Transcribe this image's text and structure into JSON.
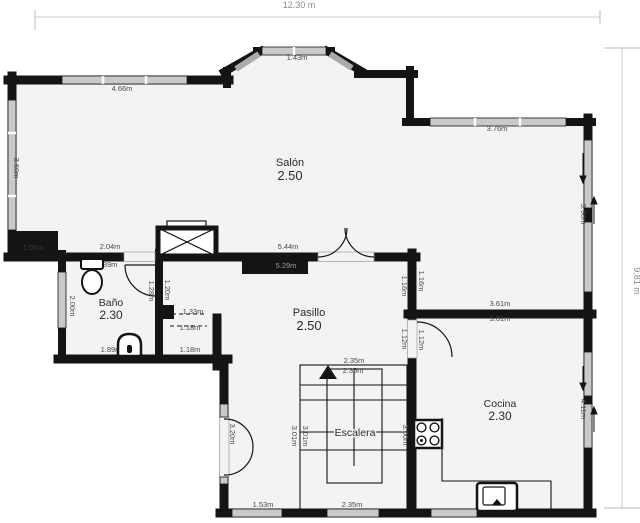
{
  "plan": {
    "title": "floor-plan",
    "overall": {
      "width_label": "12.30 m",
      "height_label": "9.81 m"
    },
    "rooms": {
      "salon": {
        "name": "Salón",
        "value": "2.50"
      },
      "bano": {
        "name": "Baño",
        "value": "2.30"
      },
      "pasillo": {
        "name": "Pasillo",
        "value": "2.50"
      },
      "cocina": {
        "name": "Cocina",
        "value": "2.30"
      },
      "escalera": {
        "name": "Escalera"
      }
    },
    "dims": {
      "salon_top_window": "4.66m",
      "bay_window": "1.43m",
      "salon_topright_window": "3.76m",
      "salon_left_window": "3.60m",
      "salon_right_window": "3.90m",
      "salon_bottom_left": "2.04m",
      "salon_bottom_right": "5.44m",
      "salon_bottom_inner": "1.89m",
      "black_box": "5.29m",
      "corner_mass": "1.05m",
      "bano_left": "2.00m",
      "bano_door_left": "1.28m",
      "bano_door_right": "1.20m",
      "bano_bottom": "1.89m",
      "closet_top": "1.33m",
      "closet_mid": "1.18m",
      "closet_bottom": "1.18m",
      "pasillo_wall_left": "1.16m",
      "pasillo_wall_right": "1.16m",
      "cocina_door_left": "1.12m",
      "cocina_door_right": "1.12m",
      "divider_top": "3.61m",
      "divider_bottom": "3.61m",
      "stair_top_outer": "2.35m",
      "stair_top_inner": "2.35m",
      "stair_left_outer": "3.01m",
      "stair_left_inner": "3.01m",
      "stair_right": "3.00m",
      "lower_left_door": "3.20m",
      "bottom_strip": "1.53m",
      "stair_bottom": "2.35m",
      "cocina_bottom": "3.61m",
      "cocina_right_window": "4.11m"
    },
    "colors": {
      "wall": "#141414",
      "window": "#c9c9c9",
      "floor": "#f3f3f3",
      "dim_text": "#4a4a4a",
      "outer_dim_text": "#8a8a8a"
    }
  }
}
